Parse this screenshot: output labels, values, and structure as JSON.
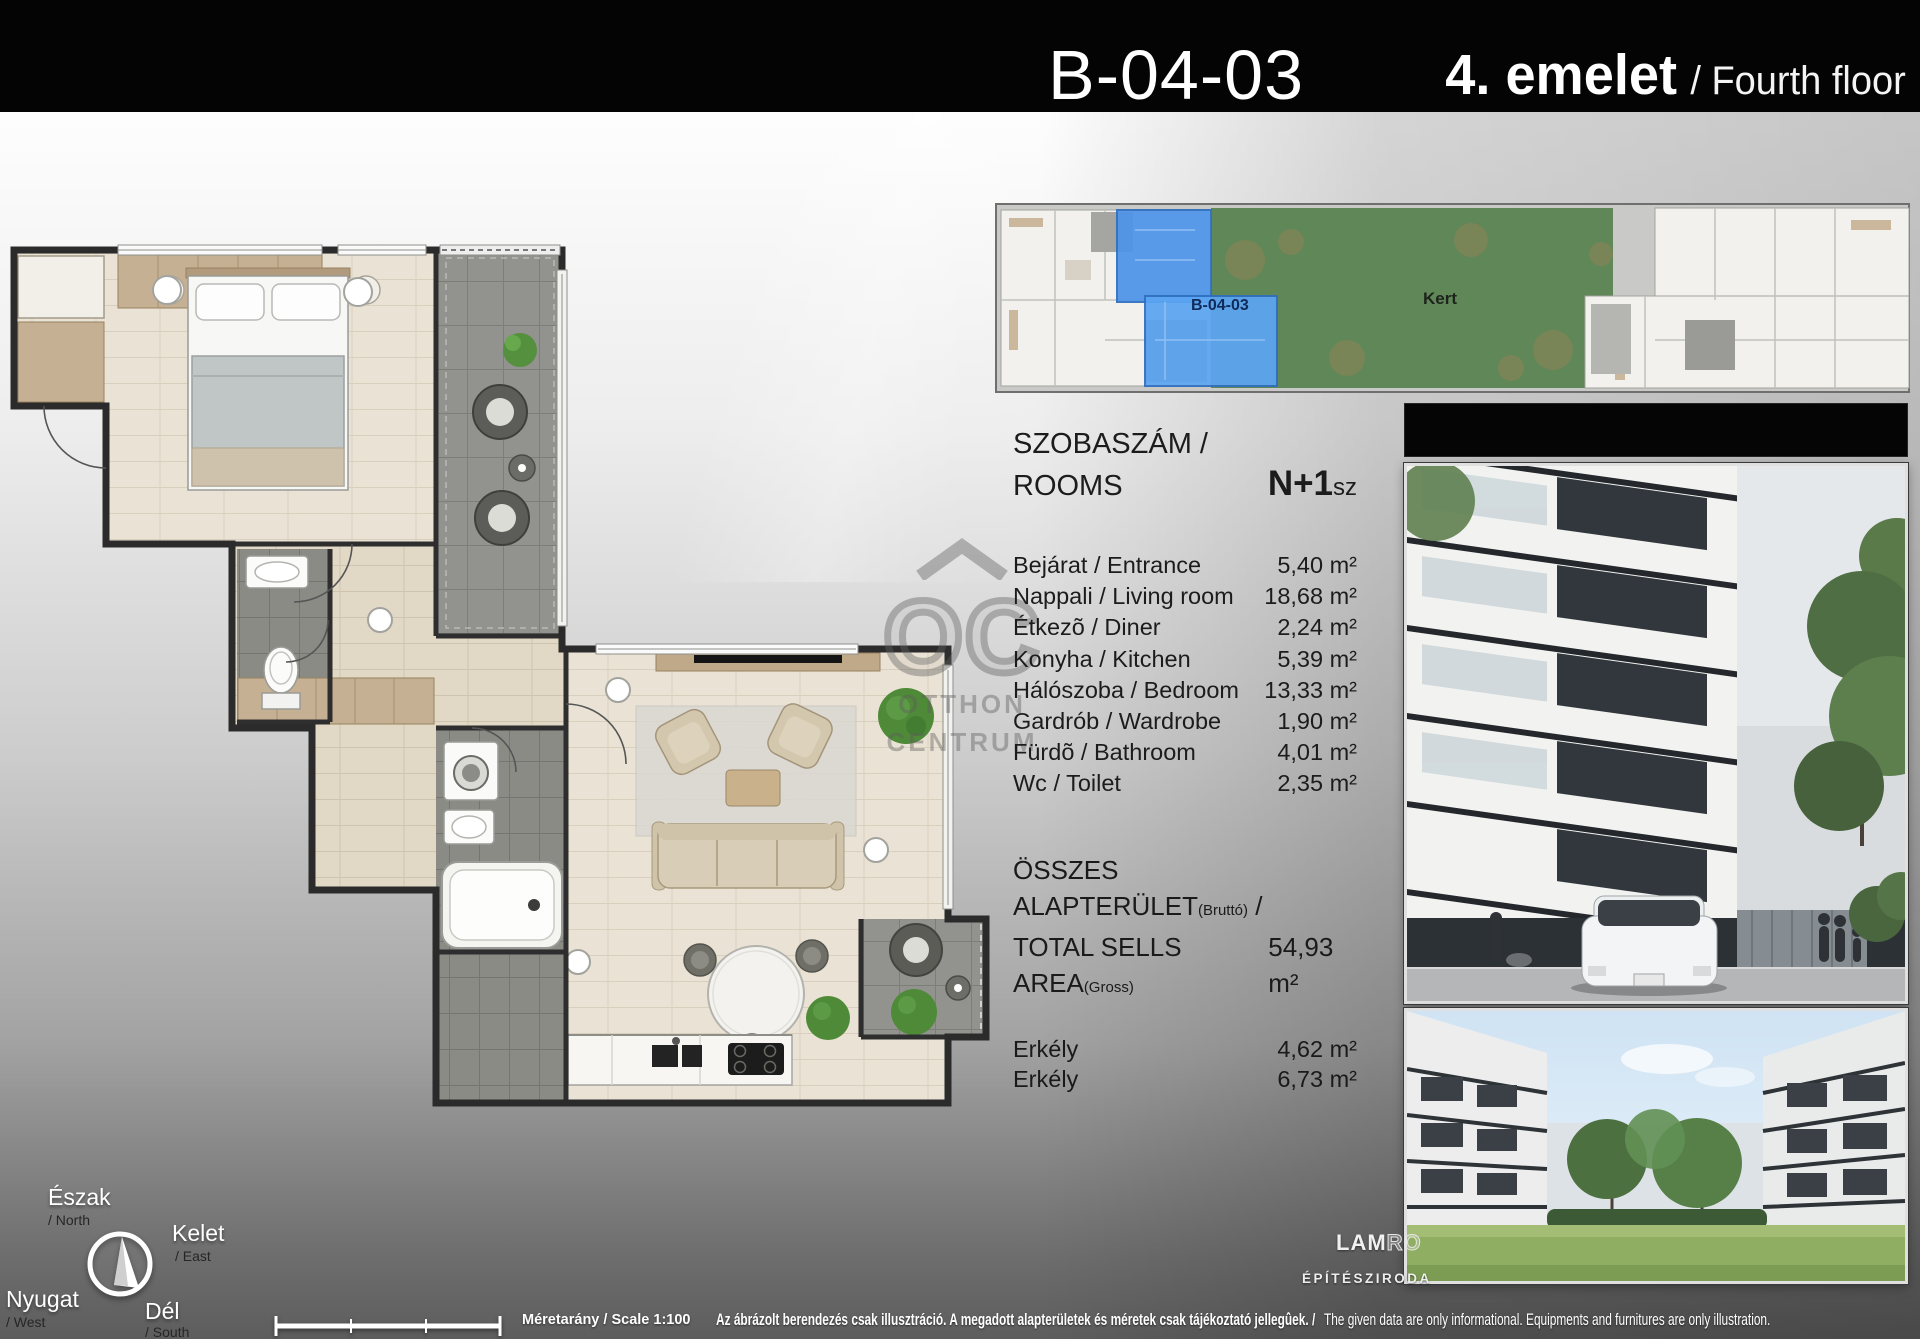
{
  "header": {
    "unit_code": "B-04-03",
    "floor_hu": "4. emelet",
    "floor_en": "/ Fourth floor"
  },
  "overview": {
    "unit_label": "B-04-03",
    "garden_label": "Kert"
  },
  "rooms": {
    "title_hu": "SZOBASZÁM /",
    "title_en": "ROOMS",
    "count": "N+1",
    "count_suffix": "sz",
    "items": [
      {
        "label": "Bejárat / Entrance",
        "area": "5,40 m²"
      },
      {
        "label": "Nappali / Living room",
        "area": "18,68 m²"
      },
      {
        "label": "Étkezõ / Diner",
        "area": "2,24 m²"
      },
      {
        "label": "Konyha / Kitchen",
        "area": "5,39 m²"
      },
      {
        "label": "Hálószoba / Bedroom",
        "area": "13,33 m²"
      },
      {
        "label": "Gardrób / Wardrobe",
        "area": "1,90 m²"
      },
      {
        "label": "Fürdõ / Bathroom",
        "area": "4,01 m²"
      },
      {
        "label": "Wc / Toilet",
        "area": "2,35 m²"
      }
    ]
  },
  "totals": {
    "title_hu": "ÖSSZES ALAPTERÜLET",
    "title_hu_note": "(Bruttó)",
    "title_sep": " /",
    "title_en": "TOTAL SELLS AREA",
    "title_en_note": "(Gross)",
    "value": "54,93 m²",
    "balconies": [
      {
        "label": "Erkély",
        "area": "4,62 m²"
      },
      {
        "label": "Erkély",
        "area": "6,73 m²"
      }
    ]
  },
  "compass": {
    "n_hu": "Észak",
    "n_en": "/ North",
    "e_hu": "Kelet",
    "e_en": "/ East",
    "s_hu": "Dél",
    "s_en": "/ South",
    "w_hu": "Nyugat",
    "w_en": "/ West"
  },
  "footer": {
    "scale_label": "Méretarány / Scale 1:100",
    "disclaimer_hu": "Az ábrázolt berendezés csak illusztráció. A megadott alapterületek és méretek csak tájékoztató jellegûek. /",
    "disclaimer_en": "The given data are only informational. Equipments and furnitures are only illustration."
  },
  "logo": {
    "part1": "LAM",
    "part2": "RO",
    "subtitle": "ÉPÍTÉSZIRODA"
  },
  "watermark": {
    "line1": "OC",
    "line2": "OTTHON",
    "line3": "CENTRUM"
  },
  "colors": {
    "accent_blue": "#4d94e8",
    "garden_green": "#5f8758",
    "header_bg": "#040404"
  }
}
